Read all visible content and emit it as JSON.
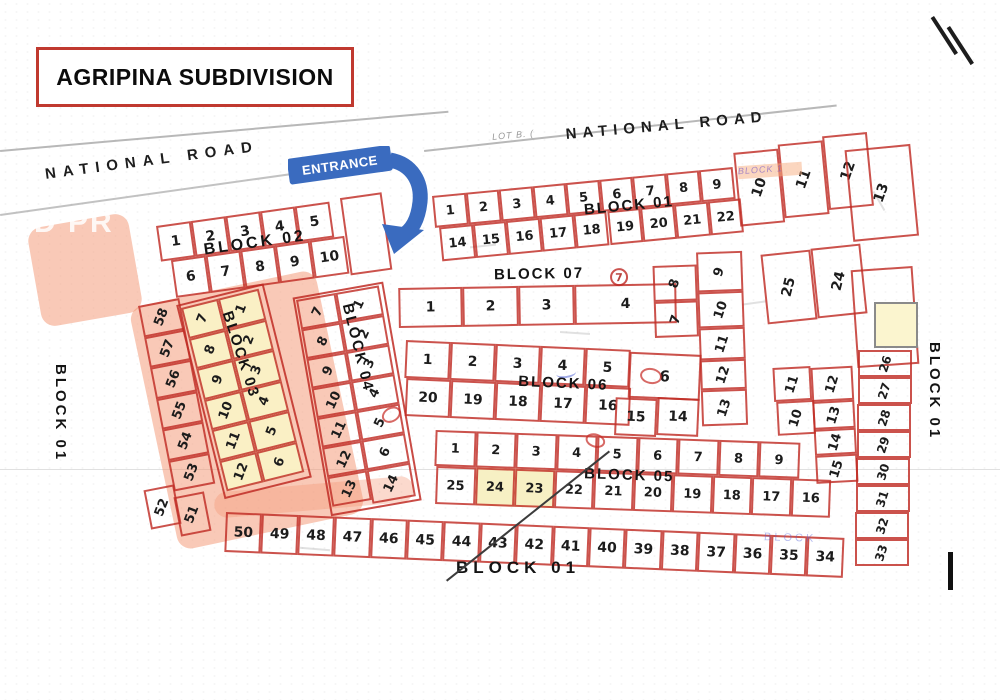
{
  "title": "AGRIPINA SUBDIVISION",
  "roads": {
    "left": "NATIONAL ROAD",
    "right": "NATIONAL ROAD"
  },
  "entrance": {
    "label": "ENTRANCE"
  },
  "blocks": {
    "block01": {
      "label_top": "BLOCK 01",
      "label_right": "BLOCK 01",
      "label_left": "BLOCK 01",
      "label_bottom": "BLOCK 01",
      "top_row": [
        "1",
        "2",
        "3",
        "4",
        "5",
        "6",
        "7",
        "8",
        "9"
      ],
      "top_tall": [
        "10",
        "11",
        "12"
      ],
      "lot13": "13",
      "second_row": [
        "14",
        "15",
        "16",
        "17",
        "18",
        "19",
        "20",
        "21",
        "22"
      ],
      "right_pair": [
        "25",
        "24"
      ],
      "lot23": "23",
      "right_col": [
        "26",
        "27",
        "28",
        "29",
        "30",
        "31",
        "32",
        "33"
      ],
      "bottom_row": [
        "50",
        "49",
        "48",
        "47",
        "46",
        "45",
        "44",
        "43",
        "42",
        "41",
        "40",
        "39",
        "38",
        "37",
        "36",
        "35",
        "34"
      ],
      "left_col": [
        "58",
        "57",
        "56",
        "55",
        "54",
        "53"
      ],
      "bend": [
        "52",
        "51"
      ]
    },
    "block02": {
      "label": "BLOCK 02",
      "row1": [
        "1",
        "2",
        "3",
        "4",
        "5"
      ],
      "row2": [
        "6",
        "7",
        "8",
        "9",
        "10"
      ]
    },
    "block03": {
      "label": "BLOCK 03",
      "col_left": [
        "7",
        "8",
        "9",
        "10",
        "11",
        "12"
      ],
      "col_right": [
        "1",
        "2",
        "3",
        "4",
        "5",
        "6"
      ]
    },
    "block04": {
      "label": "BLOCK 04",
      "col_left": [
        "7",
        "8",
        "9",
        "10",
        "11",
        "12",
        "13"
      ],
      "col_right": [
        "1",
        "2",
        "3",
        "4",
        "5",
        "6"
      ],
      "lot14": "14"
    },
    "block05": {
      "label": "BLOCK 05",
      "top_row": [
        "1",
        "2",
        "3",
        "4",
        "5",
        "6",
        "7",
        "8",
        "9"
      ],
      "bottom_row": [
        "25",
        "24",
        "23",
        "22",
        "21",
        "20",
        "19",
        "18",
        "17",
        "16"
      ],
      "highlighted_lots": [
        "24",
        "23"
      ],
      "annex_col_a": [
        "11",
        "10"
      ],
      "annex_col_b": [
        "12",
        "13",
        "14",
        "15"
      ]
    },
    "block06": {
      "label": "BLOCK 06",
      "top_row": [
        "1",
        "2",
        "3",
        "4",
        "5"
      ],
      "bottom_row": [
        "20",
        "19",
        "18",
        "17",
        "16"
      ],
      "lot6": "6",
      "lot15": "15",
      "lot14": "14",
      "annex_col_a": [
        "8",
        "7"
      ],
      "annex_col_b": [
        "9",
        "10",
        "11",
        "12",
        "13"
      ]
    },
    "block07": {
      "label": "BLOCK 07",
      "row": [
        "1",
        "2",
        "3",
        "4"
      ],
      "badge": "7"
    }
  },
  "artifacts": {
    "watermark": "D PR",
    "faded_block_1": "BLOCK 1",
    "faded_block": "BLOCK",
    "lot_note": "LOT B. ("
  },
  "colors": {
    "line_red": "#c02c24",
    "entrance_blue": "#3a6bbf",
    "highlight_yellow": "#faf3c8",
    "highlight_pink": "#f39470",
    "title_border": "#c0392f"
  }
}
